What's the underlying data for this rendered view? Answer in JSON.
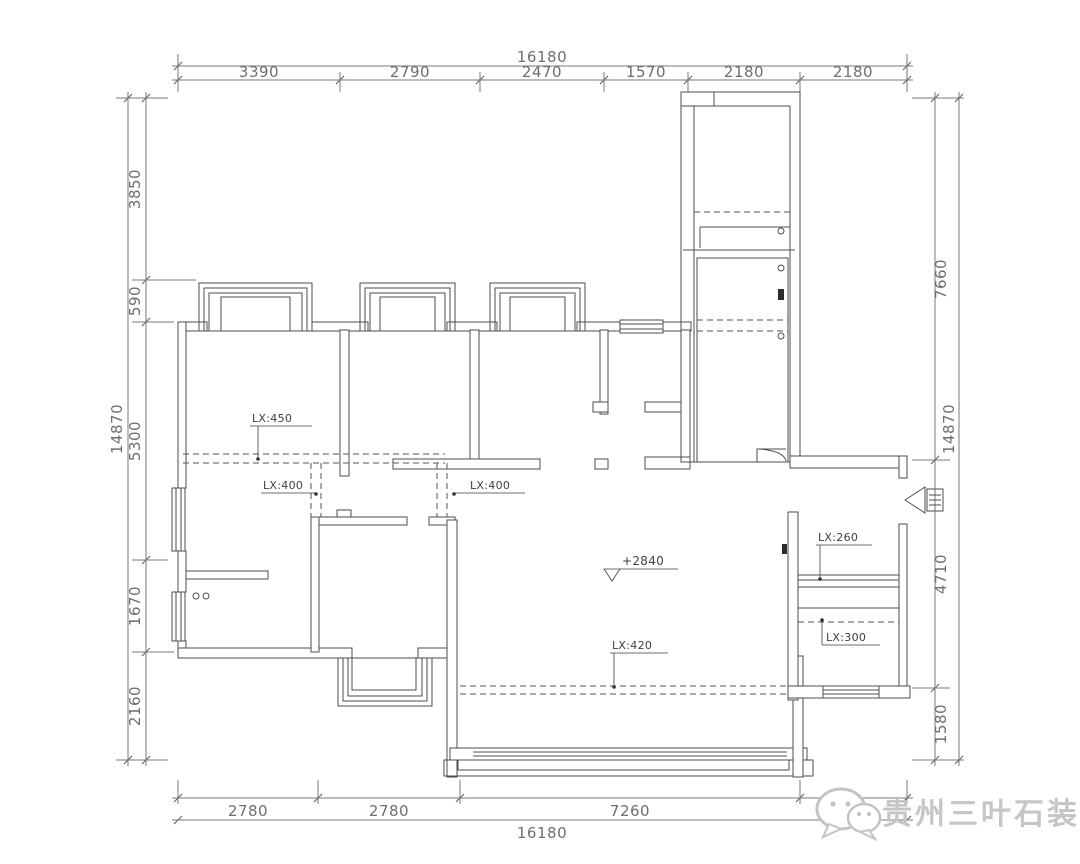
{
  "drawing": {
    "dims": {
      "top": {
        "overall": "16180",
        "segments": [
          "3390",
          "2790",
          "2470",
          "1570",
          "2180",
          "2180"
        ]
      },
      "bottom": {
        "overall": "16180",
        "segments": [
          "2780",
          "2780",
          "7260"
        ]
      },
      "left": {
        "overall": "14870",
        "segments": [
          "3850",
          "590",
          "5300",
          "1670",
          "2160"
        ]
      },
      "right": {
        "overall": "14870",
        "segments": [
          "7660",
          "4710",
          "1580"
        ]
      }
    },
    "labels": {
      "beam_bedroom": "LX:450",
      "beam_hall_left": "LX:400",
      "beam_hall_mid": "LX:400",
      "beam_living": "LX:420",
      "beam_balcony_upper": "LX:260",
      "beam_balcony_lower": "LX:300",
      "level_living": "+2840"
    },
    "watermark": {
      "text": "贵州三叶石装饰"
    },
    "colors": {
      "line": "#4d4d4d",
      "dim": "#6e6e6e",
      "annotation": "#3f3f3f",
      "watermark": "#c6c6c6",
      "background": "#ffffff"
    }
  }
}
